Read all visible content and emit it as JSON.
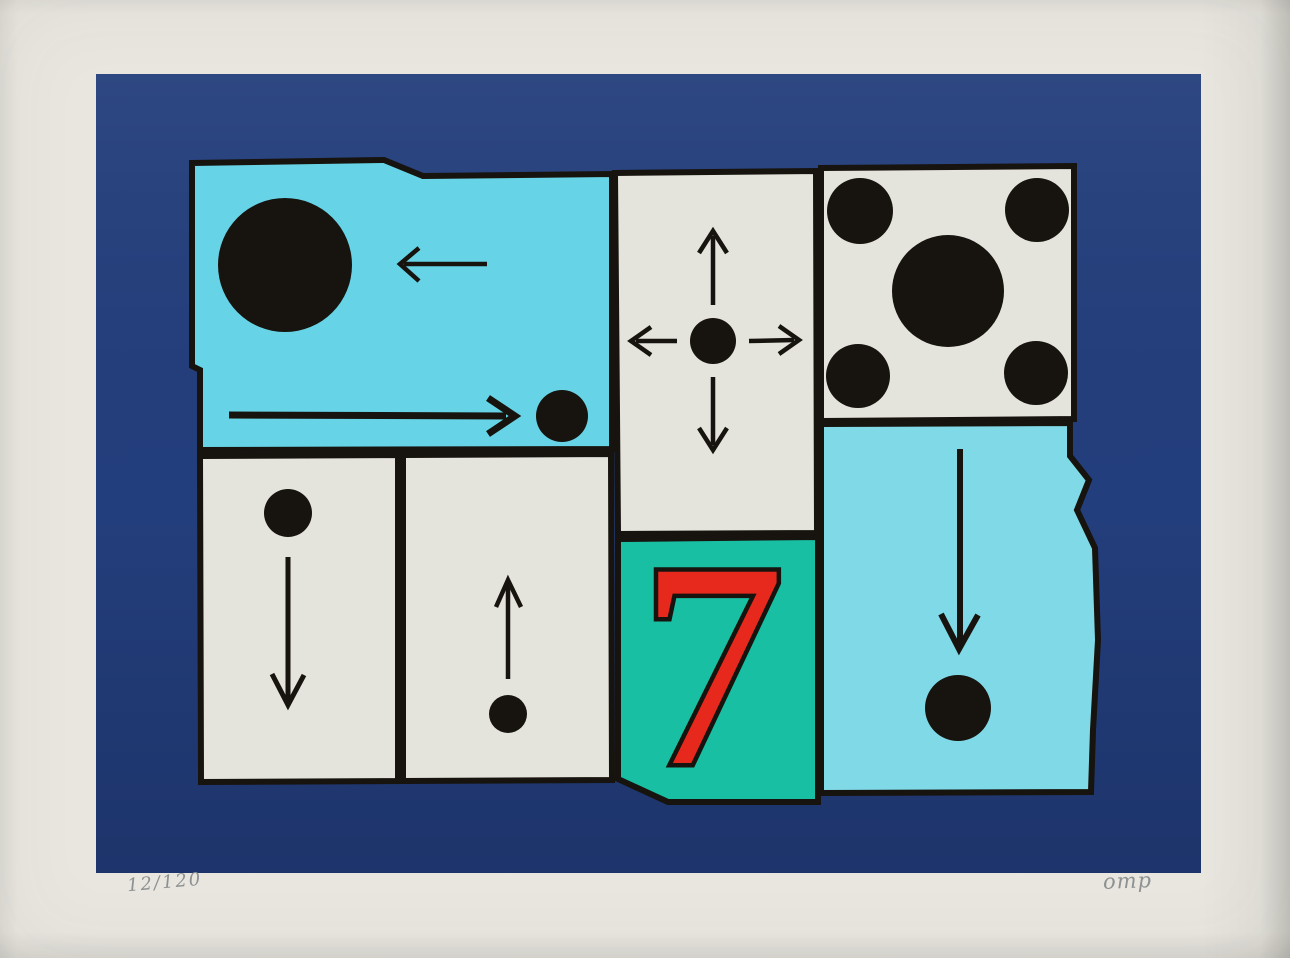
{
  "artwork": {
    "numeral": "7",
    "edition_number": "12/120",
    "signature": "omp"
  },
  "colors": {
    "paper": "#e8e6df",
    "field_blue": "#233e7c",
    "field_blue_dark": "#1e3469",
    "cyan_left": "#66d4e6",
    "cyan_right": "#7fd9e6",
    "panel_white": "#e4e3dc",
    "teal": "#18bfa3",
    "red": "#e7291d",
    "ink": "#17130e",
    "pencil": "#8d9192"
  }
}
